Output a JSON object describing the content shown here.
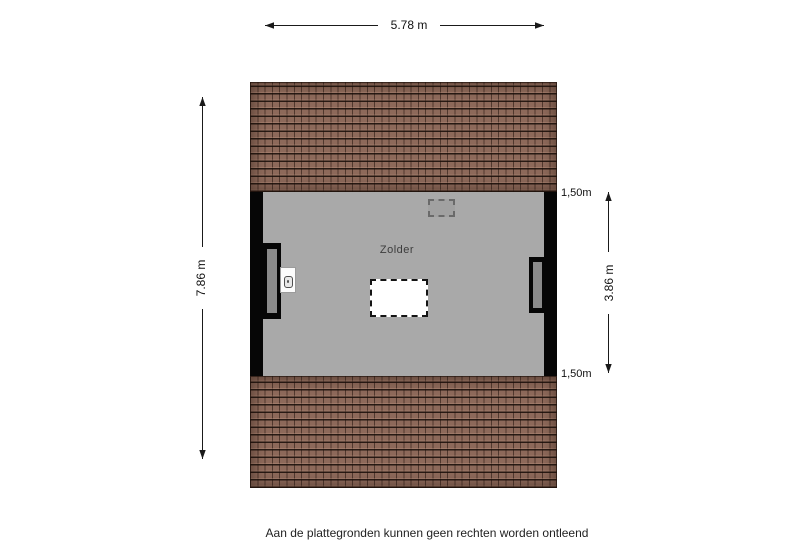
{
  "floorplan": {
    "room_label": "Zolder",
    "dimensions": {
      "width_total": "5.78 m",
      "depth_total": "7.86 m",
      "inner_depth": "3.86 m",
      "knee_height_top": "1,50m",
      "knee_height_bottom": "1,50m"
    },
    "colors": {
      "roof": "#8d695a",
      "floor": "#a9a9a9",
      "wall": "#060606",
      "window_glass": "#8a8a8a",
      "stair_opening": "#ffffff"
    }
  },
  "footer": {
    "disclaimer": "Aan de plattegronden kunnen geen rechten worden ontleend"
  }
}
